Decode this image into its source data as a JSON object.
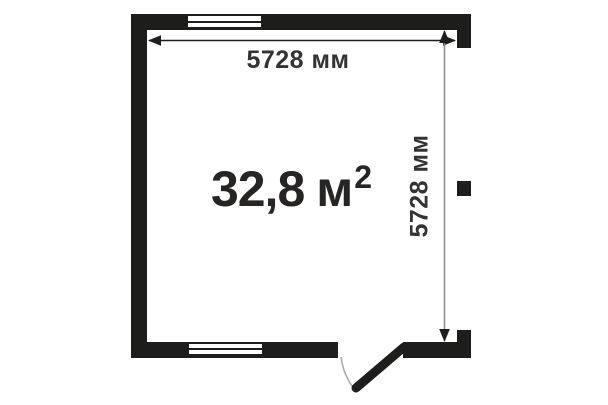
{
  "floorplan": {
    "type": "room-floor-plan",
    "area": {
      "value": "32,8",
      "unit": "м",
      "exponent": "2"
    },
    "width_dimension": "5728 мм",
    "height_dimension": "5728 мм",
    "features": {
      "windows": [
        "top-wall-window",
        "bottom-wall-window"
      ],
      "door": "bottom-right-swing-door"
    },
    "colors": {
      "wall": "#1d1d1b",
      "background": "#ffffff",
      "dimension_text": "#333331",
      "horizontal_dim_line": "#1d1d1b",
      "vertical_dim_line": "#8f8f8f",
      "door_swing_arc": "#ababab"
    }
  }
}
